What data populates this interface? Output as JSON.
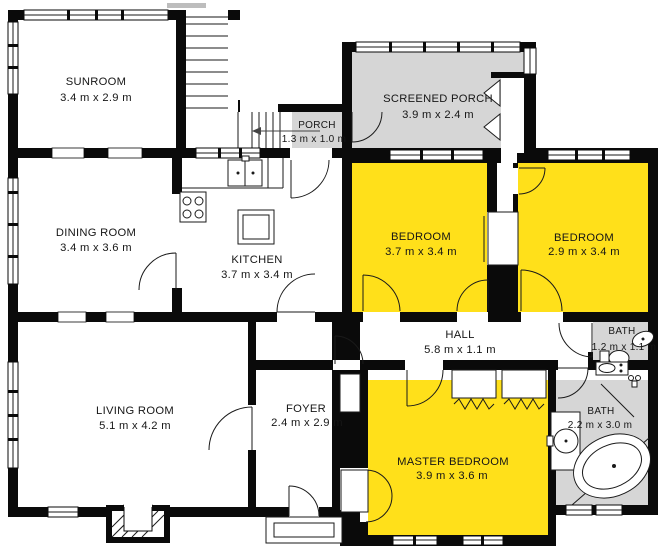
{
  "title": "Floor plan",
  "colors": {
    "highlight_yellow": "#FFE01A",
    "porch_gray": "#D6D6D6",
    "wall_black": "#0A0A0A",
    "background": "#FFFFFF"
  },
  "rooms": [
    {
      "name": "SUNROOM",
      "dimensions": "3.4 m x 2.9 m",
      "fill": "white"
    },
    {
      "name": "SCREENED PORCH",
      "dimensions": "3.9 m x 2.4 m",
      "fill": "gray"
    },
    {
      "name": "PORCH",
      "dimensions": "1.3 m x 1.0 m",
      "fill": "gray"
    },
    {
      "name": "DINING ROOM",
      "dimensions": "3.4 m x 3.6 m",
      "fill": "white"
    },
    {
      "name": "KITCHEN",
      "dimensions": "3.7 m x 3.4 m",
      "fill": "white"
    },
    {
      "name": "BEDROOM",
      "dimensions": "3.7 m x 3.4 m",
      "fill": "yellow"
    },
    {
      "name": "BEDROOM",
      "dimensions": "2.9 m x 3.4 m",
      "fill": "yellow"
    },
    {
      "name": "HALL",
      "dimensions": "5.8 m x 1.1 m",
      "fill": "white"
    },
    {
      "name": "BATH",
      "dimensions": "1.2 m x 1.1 m",
      "fill": "gray"
    },
    {
      "name": "BATH",
      "dimensions": "2.2 m x 3.0 m",
      "fill": "gray"
    },
    {
      "name": "LIVING ROOM",
      "dimensions": "5.1 m x 4.2 m",
      "fill": "white"
    },
    {
      "name": "FOYER",
      "dimensions": "2.4 m x 2.9 m",
      "fill": "white"
    },
    {
      "name": "MASTER BEDROOM",
      "dimensions": "3.9 m x 3.6 m",
      "fill": "yellow"
    }
  ],
  "fixtures": [
    "stove",
    "kitchen-sink",
    "kitchen-island",
    "stairs",
    "fireplace",
    "toilet",
    "bathtub",
    "vanity-sink",
    "closet",
    "front-stoop"
  ]
}
